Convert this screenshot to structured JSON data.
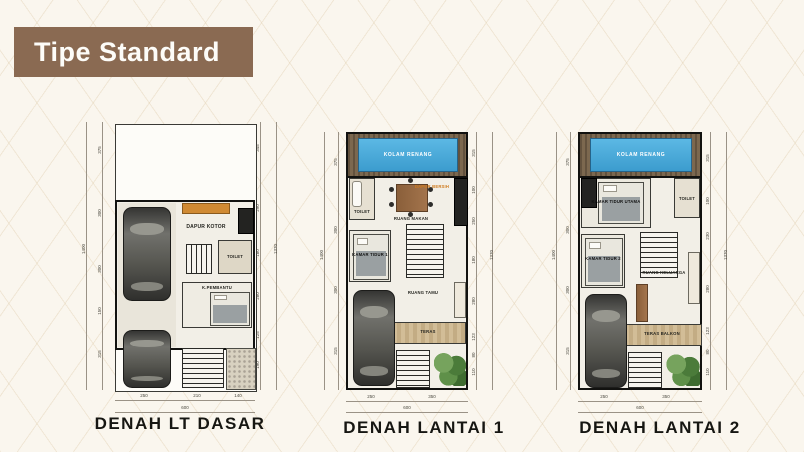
{
  "banner": {
    "label": "Tipe Standard"
  },
  "colors": {
    "banner_brown": "#8a6a52",
    "background_cream": "#faf6ee",
    "pool_blue": "#45a7d6",
    "deck_wood": "#6e5b44",
    "counter_orange": "#d08a33",
    "greenery": "#4b7b3a",
    "wall_black": "#121210",
    "title_text": "#161612"
  },
  "plans": [
    {
      "title": "DENAH LT DASAR",
      "labels": {
        "kitchen_dirty": "DAPUR KOTOR",
        "toilet": "TOILET",
        "maid_room": "K.PEMBANTU"
      },
      "dims": {
        "bottom": [
          "250",
          "210",
          "140"
        ],
        "bottom_total": "600",
        "left": [
          "375",
          "300",
          "300",
          "150",
          "315"
        ],
        "left_total": "1400",
        "right": [
          "345",
          "290",
          "180",
          "280",
          "125",
          "190"
        ],
        "right_total": "1370"
      }
    },
    {
      "title": "DENAH LANTAI 1",
      "labels": {
        "pool": "KOLAM RENANG",
        "toilet": "TOILET",
        "dining": "RUANG MAKAN",
        "kitchen_clean": "DAPUR BERSIH",
        "bedroom1": "KAMAR TIDUR 1",
        "living": "RUANG TAMU",
        "terrace": "TERAS"
      },
      "dims": {
        "bottom": [
          "250",
          "350"
        ],
        "bottom_total": "600",
        "left": [
          "375",
          "300",
          "300",
          "315"
        ],
        "left_total": "1400",
        "right": [
          "315",
          "100",
          "250",
          "180",
          "280",
          "123",
          "80",
          "110"
        ],
        "right_total": "1370"
      }
    },
    {
      "title": "DENAH LANTAI 2",
      "labels": {
        "pool": "KOLAM RENANG",
        "master_bedroom": "KAMAR TIDUR UTAMA",
        "toilet": "TOILET",
        "bedroom2": "KAMAR TIDUR 2",
        "family": "RUANG KELUARGA",
        "balcony": "TERAS BALKON"
      },
      "dims": {
        "bottom": [
          "250",
          "350"
        ],
        "bottom_total": "600",
        "left": [
          "375",
          "300",
          "300",
          "315"
        ],
        "left_total": "1400",
        "right": [
          "315",
          "100",
          "230",
          "280",
          "123",
          "80",
          "110"
        ],
        "right_total": "1370"
      }
    }
  ]
}
